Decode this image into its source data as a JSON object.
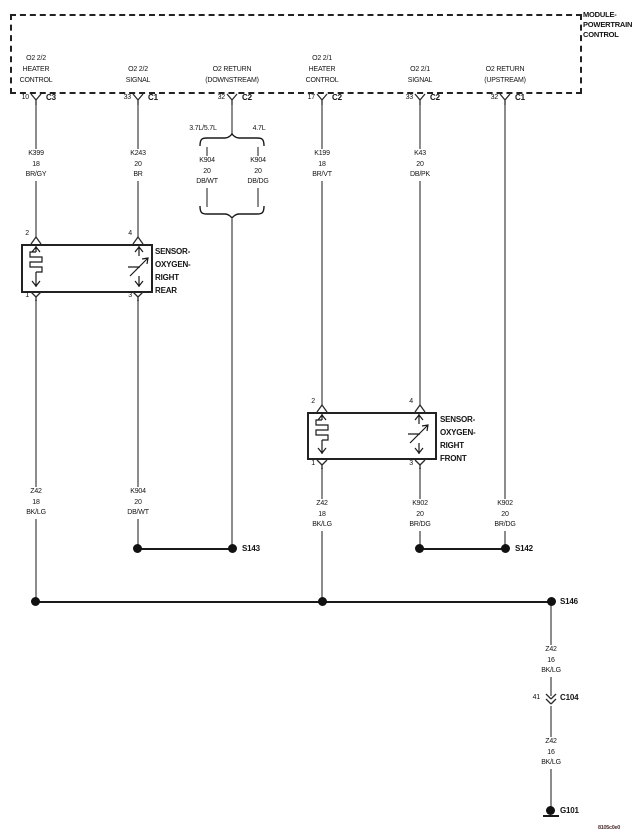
{
  "module": {
    "label": "MODULE-\nPOWERTRAIN\nCONTROL",
    "pins": [
      {
        "signal": "O2 2/2\nHEATER\nCONTROL",
        "pin": "10",
        "connector": "C3"
      },
      {
        "signal": "O2 2/2\nSIGNAL",
        "pin": "33",
        "connector": "C1"
      },
      {
        "signal": "O2 RETURN\n(DOWNSTREAM)",
        "pin": "32",
        "connector": "C2"
      },
      {
        "signal": "O2 2/1\nHEATER\nCONTROL",
        "pin": "17",
        "connector": "C2"
      },
      {
        "signal": "O2 2/1\nSIGNAL",
        "pin": "33",
        "connector": "C2"
      },
      {
        "signal": "O2 RETURN\n(UPSTREAM)",
        "pin": "32",
        "connector": "C1"
      }
    ]
  },
  "engine_branches": {
    "left": "3.7L/5.7L",
    "right": "4.7L"
  },
  "wire_labels": {
    "k399": "K399\n18\nBR/GY",
    "k243": "K243\n20\nBR",
    "k904_dbwt": "K904\n20\nDB/WT",
    "k904_dbdg": "K904\n20\nDB/DG",
    "k199": "K199\n18\nBR/VT",
    "k43": "K43\n20\nDB/PK",
    "z42_rear": "Z42\n18\nBK/LG",
    "k904_lower": "K904\n20\nDB/WT",
    "z42_front": "Z42\n18\nBK/LG",
    "k902_signal": "K902\n20\nBR/DG",
    "k902_return": "K902\n20\nBR/DG",
    "z42_16_upper": "Z42\n16\nBK/LG",
    "z42_16_lower": "Z42\n16\nBK/LG"
  },
  "sensor_rear": {
    "label": "SENSOR-\nOXYGEN-\nRIGHT\nREAR",
    "pin_top_left": "2",
    "pin_top_right": "4",
    "pin_bottom_left": "1",
    "pin_bottom_right": "3"
  },
  "sensor_front": {
    "label": "SENSOR-\nOXYGEN-\nRIGHT\nFRONT",
    "pin_top_left": "2",
    "pin_top_right": "4",
    "pin_bottom_left": "1",
    "pin_bottom_right": "3"
  },
  "splices": {
    "s143": "S143",
    "s142": "S142",
    "s146": "S146"
  },
  "inline_connector": {
    "pin": "41",
    "name": "C104"
  },
  "ground": {
    "name": "G101"
  },
  "footer": {
    "diagram_id": "8105c0e0"
  },
  "colors": {
    "wire_gray": "#8c8c8c",
    "line_black": "#1a1a1a"
  }
}
